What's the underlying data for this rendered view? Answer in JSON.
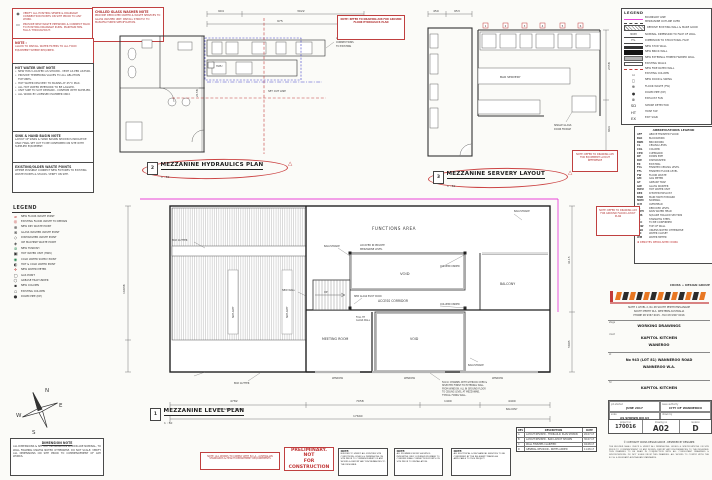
{
  "colors": {
    "red": "#c23b3b",
    "pink": "#e845d8",
    "blue": "#3d3dc8",
    "orange": "#e87722",
    "line": "#444444"
  },
  "icons": {
    "rev_triangle": "△",
    "drain1": "◉",
    "drain2": "▭",
    "bullet": "•",
    "copyright": "©"
  },
  "left": {
    "drain_box": {
      "items": [
        {
          "g": "◉",
          "t": "VERIFY ALL EXISTING SEWER & DRAINAGE CONNECTION POINTS ON SITE PRIOR TO ANY WORK."
        },
        {
          "g": "▭",
          "t": "PROVIDE NEW WASTE PIPEWORK & CONNECT BACK TO EXISTING DRAINAGE RUNS. MAINTAIN MIN. FALLS THROUGHOUT."
        }
      ]
    },
    "washer_box": {
      "title": "CHILLED GLASS WASHER NOTE",
      "body": "PROVIDE DEDICATED WATER & WASTE SERVICES TO GLASS WASHER UNIT. INSTALL STRICTLY TO MANUFACTURER SPECIFICATION."
    },
    "red_note": {
      "title": "NOTE :",
      "body": "ALLOW TO INSTALL WATER FILTERS TO ALL FOOD EQUIPMENT WHERE REQUIRED."
    },
    "hwu_note": {
      "title": "HOT WATER UNIT NOTE",
      "bullets": [
        "NEW HWU LOCATED AS SHOWN - VENT AS PER AS3500.",
        "PROVIDE TEMPERING VALVES TO ALL ABLUTION FIXTURES.",
        "HOT WATER DELIVERY TO BASINS AT 45°C MAX.",
        "ALL HOT WATER PIPEWORK TO BE LAGGED.",
        "UNIT SIZE TO SUIT DEMAND - CONFIRM WITH SUPPLIER.",
        "ALL WORK BY LICENSED PLUMBER ONLY."
      ]
    },
    "sink_note": {
      "title": "SINK & HAND BASIN NOTE",
      "body": "LAYOUT OF SINKS & HAND BASINS SHOWN IS INDICATIVE ONLY. FINAL SET OUT TO BE CONFIRMED ON SITE WITH SUPPLIED EQUIPMENT."
    },
    "waste_note": {
      "title": "EXISTING/OLDER WASTE POINTS",
      "body": "WHERE POSSIBLE CONNECT NEW FIXTURES TO EXISTING WASTE POINTS & STACKS. VERIFY ON SITE."
    },
    "legend": {
      "title": "LEGEND",
      "items": [
        {
          "g": "⌀",
          "c": "c-red",
          "t": "NEW FLOOR WASTE POINT"
        },
        {
          "g": "◎",
          "c": "c-red",
          "t": "EXISTING FLOOR WASTE TO REMAIN"
        },
        {
          "g": "⊕",
          "c": "c-blk",
          "t": "NEW DRY WASTE POINT"
        },
        {
          "g": "⊗",
          "c": "c-blk",
          "t": "GLASS WASHER WASTE POINT"
        },
        {
          "g": "◇",
          "c": "c-blk",
          "t": "DISHWASHER WASTE POINT"
        },
        {
          "g": "◈",
          "c": "c-blk",
          "t": "ICE MACHINE WASTE POINT"
        },
        {
          "g": "⊚",
          "c": "c-grn",
          "t": "NEW TUNDISH"
        },
        {
          "g": "▣",
          "c": "c-blk",
          "t": "HOT WATER UNIT (HWU)"
        },
        {
          "g": "◉",
          "c": "c-grn",
          "t": "COLD WATER SUPPLY POINT"
        },
        {
          "g": "◐",
          "c": "c-blk",
          "t": "HOT & COLD WATER POINT"
        },
        {
          "g": "✛",
          "c": "c-red",
          "t": "NEW WATER METER"
        },
        {
          "g": "▢",
          "c": "c-blk",
          "t": "GAS POINT"
        },
        {
          "g": "⬡",
          "c": "c-blk",
          "t": "GREASE TRAP UNDER"
        },
        {
          "g": "▪",
          "c": "c-blk",
          "t": "NEW COLUMN"
        },
        {
          "g": "▫",
          "c": "c-blk",
          "t": "EXISTING COLUMN"
        },
        {
          "g": "●",
          "c": "c-blk",
          "t": "DOWN PIPE (DP)"
        }
      ]
    },
    "compass": {
      "n": "N",
      "e": "E",
      "s": "S",
      "w": "W"
    },
    "dim_note": {
      "title": "DIMENSION NOTE",
      "body": "ALL DIMENSIONS & SET OUT INFORMATION SHOWN ARE NOMINAL, TO WALL FRAMING UNLESS NOTED OTHERWISE. DO NOT SCALE. VERIFY ALL DIMENSIONS ON SITE PRIOR TO COMMENCEMENT OF ANY WORKS."
    }
  },
  "plans": {
    "hydraulics": {
      "num": "2",
      "title": "MEZZANINE HYDRAULICS PLAN",
      "scale": "1 : 50",
      "set_out": "SET OUT LINE",
      "hwu": "HWU",
      "dry_waste": [
        "ALL DRY WASTE",
        "CONNECTIONS",
        "TO EXISTING"
      ],
      "dims": [
        "904",
        "3022",
        "975",
        "2158"
      ]
    },
    "servery": {
      "num": "3",
      "title": "MEZZANINE SERVERY LAYOUT",
      "scale": "1 : 50",
      "bar": "BAR SERVERY",
      "fridge": [
        "SINGLE GLASS",
        "DOOR FRIDGE"
      ],
      "dims": [
        "450",
        "953",
        "2358",
        "964"
      ],
      "tags": [
        "1",
        "2",
        "3",
        "4",
        "5",
        "6"
      ]
    },
    "level": {
      "num": "1",
      "title": "MEZZANINE LEVEL PLAN",
      "scale": "1 : 50",
      "rooms": {
        "functions": "FUNCTIONS AREA",
        "functions_note1": "LOCATED IN PRIVATE",
        "functions_note2": "MEZZANINE LEVEL",
        "void1": "VOID",
        "void2": "VOID",
        "corridor": "ACCESS CORRIDOR",
        "meeting": "MEETING ROOM",
        "balcony": "BALCONY"
      },
      "ann": {
        "balustrade": "BALUSTRADE",
        "column": "COLUMN UNDER",
        "new_wall": "NEW WALL",
        "pivot": "NEW GLASS PIVOT DOOR",
        "glass_wall1": "FULL HT",
        "glass_wall2": "GLASS WALL",
        "gutter": "BOX GUTTER",
        "window": "WINDOW",
        "skylight": "SKYLIGHT",
        "up": "UP",
        "note_lines": [
          "50mm CHANNEL WITH GYPROCK OVER &",
          "SELECTED FINISH TO EXTERNAL WALL",
          "FROM WINDOW. ALL IN GROUND FLOOR",
          "TO CEILING LEVEL AT MEZZANINE,",
          "TYPICAL FIXING WALL."
        ]
      },
      "dims": {
        "bottom": [
          "4782",
          "7058",
          "1400",
          "4400"
        ],
        "bottom_total": "17640",
        "label_floor": "MEZZANINE FLOOR",
        "label_balcony": "BALCONY",
        "left": "16938",
        "right1": "4115",
        "right2": "5905"
      }
    }
  },
  "notes": {
    "a08": "NOTE: REFER TO DRAWING A08 FOR GROUND FLOOR HYDRAULICS PLAN",
    "a05": "NOTE: REFER TO DRAWING A05 FOR EQUIPMENT LAYOUT REFERENCE",
    "a03": "NOTE: REFER TO DRAWING A03 FOR GROUND FLOOR LAYOUT PLAN",
    "compliance": "NOTE: ALL WORKS TO COMPLY WITH B.C.A., AUSTRALIAN STANDARDS & HEALTH DEPARTMENT REQUIREMENTS",
    "preliminary1": "PRELIMINARY. NOT",
    "preliminary2": "FOR CONSTRUCTION",
    "grey": [
      {
        "t": "NOTE:",
        "b": "BUILDER TO VERIFY ALL EXISTING SITE CONDITIONS, LEVELS & DIMENSIONS ON SITE PRIOR TO COMMENCEMENT OF ANY WORKS & REPORT ANY DISCREPANCIES TO THE DESIGNER."
      },
      {
        "t": "NOTE:",
        "b": "ALL PLUMBING WORK SHOWN IS INDICATIVE ONLY. LICENSED PLUMBER TO CONFIRM FINAL CONNECTION POINTS ON SITE PRIOR TO INSTALLATION."
      },
      {
        "t": "NOTE:",
        "b": "ALL ELECTRICAL & MECHANICAL SERVICES TO BE CONFIRMED BY THE RELEVANT TRADES AS APPLICABLE TO THIS PROJECT."
      }
    ]
  },
  "revisions": {
    "headers": [
      "REV",
      "DESCRIPTION",
      "DATE"
    ],
    "rows": [
      {
        "rev": "A",
        "desc": "LAYOUT REVISED - HYDRAULIC PLAN SHOWN",
        "date": "26.07.17"
      },
      {
        "rev": "B",
        "desc": "LAYOUT REVISED - BAR LAYOUT SHOWN",
        "date": "30.07.17"
      },
      {
        "rev": "C",
        "desc": "WALL FINISHES CLARIFIED",
        "date": "04.08.17"
      },
      {
        "rev": "D",
        "desc": "GENERAL REVISION - NOTES ADDED",
        "date": "11.08.17"
      }
    ]
  },
  "right": {
    "legend": {
      "title": "LEGEND",
      "items": [
        {
          "sw": "sw-pink",
          "g": "",
          "t": "BOUNDARY LINE"
        },
        {
          "sw": "sw-dash",
          "g": "",
          "t": "MEZZANINE OUTLINE OVER"
        },
        {
          "sw": "sw-hatch",
          "g": "",
          "t": "REMOVE EXISTING WALL & MAKE GOOD"
        },
        {
          "sw": "sw-arrow",
          "g": "NOM",
          "t": "NOMINAL DIMENSION TO FACE OF WALL"
        },
        {
          "sw": "sw-arrow",
          "g": "F.S.",
          "t": "DIMENSION TO STRUCTURAL FACE"
        },
        {
          "sw": "sw-solid",
          "g": "",
          "t": "NEW STUD WALL"
        },
        {
          "sw": "sw-thick",
          "g": "",
          "t": "NEW BRICK WALL"
        },
        {
          "sw": "sw-grey",
          "g": "",
          "t": "NEW EXTERNAL TIMBER FRAMED WALL"
        },
        {
          "sw": "sw-outline",
          "g": "",
          "t": "EXISTING WALLS"
        },
        {
          "sw": "sw-reddash",
          "g": "",
          "t": "NEW FIRE RATED WALL"
        },
        {
          "sw": "sw-sym",
          "g": "▫",
          "t": "EXISTING COLUMN"
        },
        {
          "sw": "sw-sym",
          "g": "◻",
          "t": "NEW DOOR & SWING"
        },
        {
          "sw": "sw-sym",
          "g": "⊕",
          "t": "FLOOR WASTE (FW)"
        },
        {
          "sw": "sw-sym",
          "g": "●",
          "t": "DOWN PIPE (DP)"
        },
        {
          "sw": "sw-sym",
          "g": "⊗",
          "t": "EXHAUST FAN"
        },
        {
          "sw": "sw-sym",
          "g": "SD",
          "t": "SMOKE DETECTOR"
        },
        {
          "sw": "sw-sym",
          "g": "HT",
          "t": "HOSE TAP"
        },
        {
          "sw": "sw-sym",
          "g": "EX",
          "t": "EXIT SIGN"
        }
      ]
    },
    "abbr": {
      "title": "ABBREVIATIONS LEGEND",
      "red_note": "✱  DENOTES DEMOLISHED WORK",
      "items": [
        {
          "a": "AFF",
          "t": "ABOVE FINISHED FLOOR"
        },
        {
          "a": "BLK",
          "t": "BLOCKWORK"
        },
        {
          "a": "BWK",
          "t": "BRICKWORK"
        },
        {
          "a": "CL",
          "t": "CEILING LEVEL"
        },
        {
          "a": "COL",
          "t": "COLUMN"
        },
        {
          "a": "CPD",
          "t": "CUPBOARD"
        },
        {
          "a": "DP",
          "t": "DOWN PIPE"
        },
        {
          "a": "DW",
          "t": "DISHWASHER"
        },
        {
          "a": "EX",
          "t": "EXISTING"
        },
        {
          "a": "FCL",
          "t": "FINISHED CEILING LEVEL"
        },
        {
          "a": "FFL",
          "t": "FINISHED FLOOR LEVEL"
        },
        {
          "a": "FW",
          "t": "FLOOR WASTE"
        },
        {
          "a": "GM",
          "t": "GAS METER"
        },
        {
          "a": "GT",
          "t": "GREASE TRAP"
        },
        {
          "a": "GW",
          "t": "GLASS WASHER"
        },
        {
          "a": "HWU",
          "t": "HOT WATER UNIT"
        },
        {
          "a": "KEX",
          "t": "KITCHEN EXHAUST"
        },
        {
          "a": "MSB",
          "t": "MAIN SWITCH BOARD"
        },
        {
          "a": "NOM",
          "t": "NOMINAL"
        },
        {
          "a": "O/H",
          "t": "OVERHEAD"
        },
        {
          "a": "RL",
          "t": "REDUCED LEVEL"
        },
        {
          "a": "RWH",
          "t": "RAIN WATER HEAD"
        },
        {
          "a": "SHS",
          "t": "SQUARE HOLLOW SECTION"
        },
        {
          "a": "SS",
          "t": "STAINLESS STEEL"
        },
        {
          "a": "TBC",
          "t": "TO BE CONFIRMED"
        },
        {
          "a": "TOW",
          "t": "TOP OF WALL"
        },
        {
          "a": "UNO",
          "t": "UNLESS NOTED OTHERWISE"
        },
        {
          "a": "WC",
          "t": "WATER CLOSET"
        },
        {
          "a": "WM",
          "t": "WATER METER"
        }
      ]
    },
    "tb": {
      "logo": "CROSS + DESIGN GROUP",
      "addr1": "SUITE 1 LEVEL 2, No 48 SOUTH PERTH ESPLANADE",
      "addr2": "SOUTH PERTH W.A. WESTERN AUSTRALIA",
      "addr3": "PHONE 08 9367 6015  -  FAX 08 9367 6016",
      "stage_label": "stage",
      "stage": "WORKING DRAWINGS",
      "client_label": "client",
      "client1": "KAPITOL KITCHEN",
      "client2": "WANEROO",
      "at_label": "at",
      "at1": "No 943 (LOT 81) WANNEROO ROAD",
      "at2": "WANNEROO W.A.",
      "for_label": "for",
      "for": "KAPITOL KITCHEN",
      "job_label": "job started",
      "job": "JUNE 2017",
      "issue_label": "issue authority",
      "issue": "CITY OF WANNEROO",
      "scale_label": "scale",
      "scale": "AS SHOWN ON A3",
      "drawn_label": "drawn by",
      "drawn": "",
      "proj_label": "project no",
      "proj": "170016",
      "dwg_label": "drawing no",
      "dwg": "A02",
      "rev_label": "revision",
      "rev": "D",
      "copyright": "© COPYRIGHT CROSS DESIGN GROUP - RESERVED BY DESIGNER",
      "disclaimer": "THE BUILDER SHALL CHECK & VERIFY ALL DIMENSIONS, LEVELS & SPECIFICATIONS ON SITE PRIOR TO COMMENCEMENT OF ANY WORKS. REPORT ANY DISCREPANCIES TO THE DESIGNER. THIS DRAWING TO BE READ IN CONJUNCTION WITH ALL CONSULTANT DRAWINGS & SPECIFICATIONS. DO NOT SCALE FROM THIS DRAWING. ALL WORKS TO COMPLY WITH THE B.C.A. & RELEVANT AUSTRALIAN STANDARDS."
    }
  }
}
